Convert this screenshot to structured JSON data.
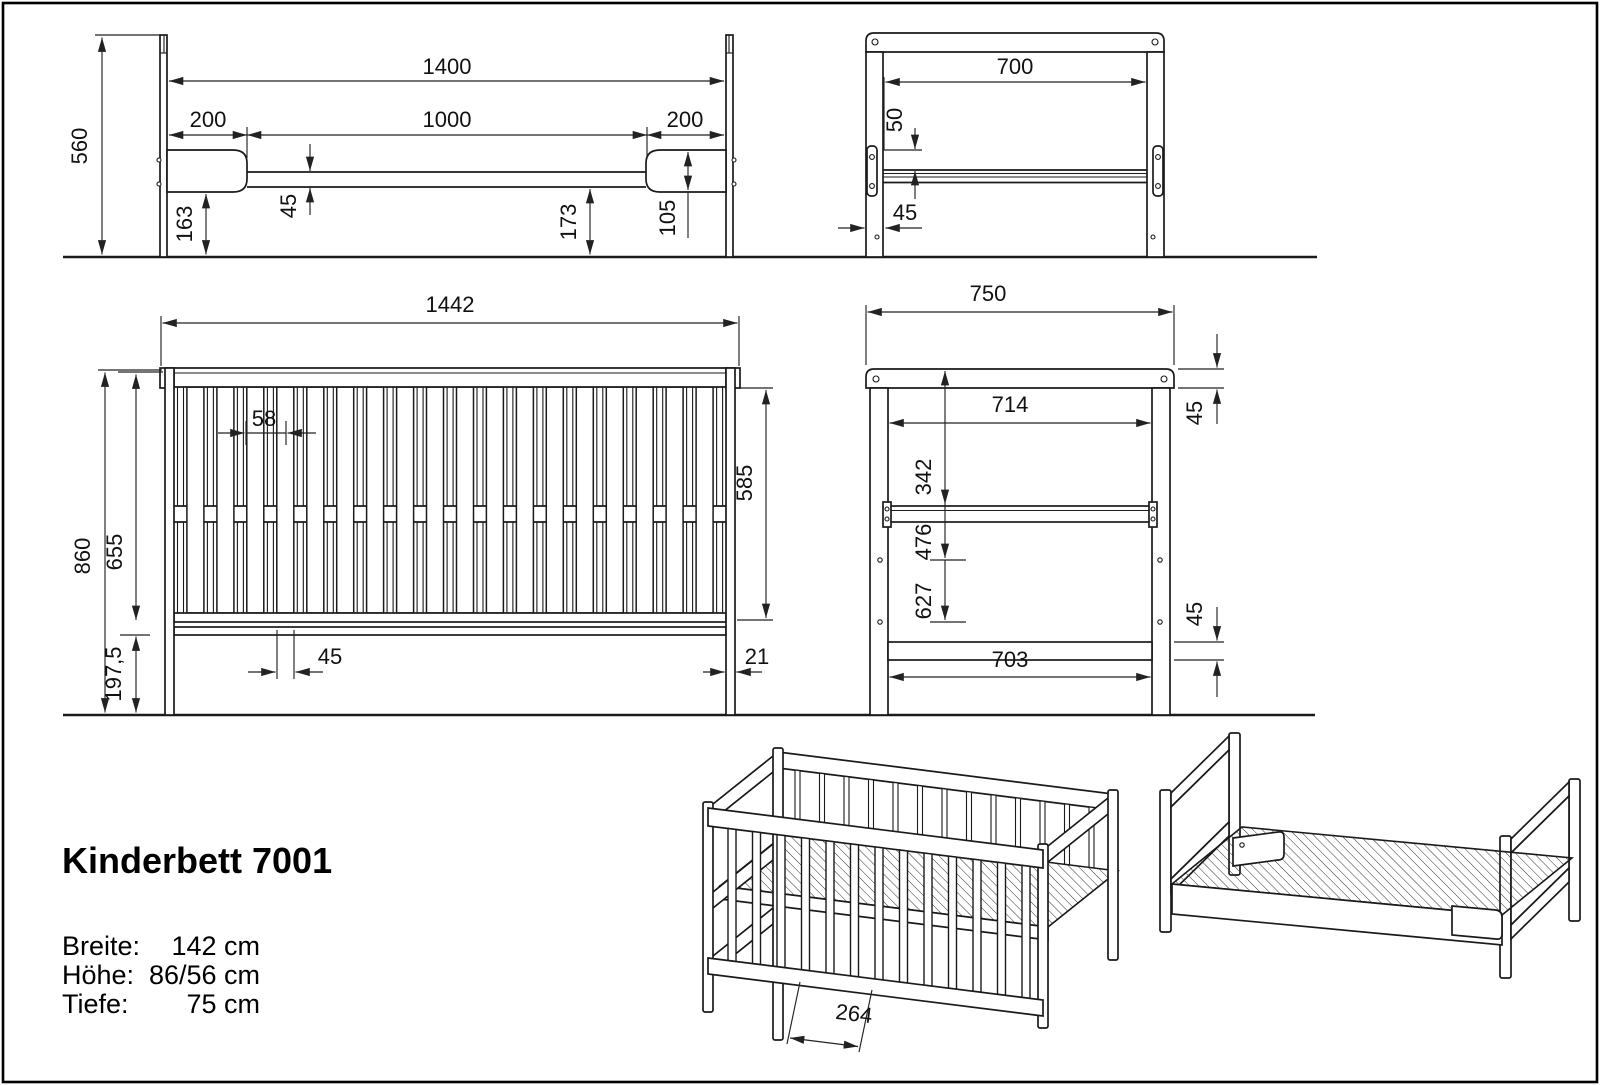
{
  "product": {
    "title": "Kinderbett 7001",
    "specs": [
      {
        "label": "Breite:",
        "value": "142 cm"
      },
      {
        "label": "Höhe:",
        "value": "86/56 cm"
      },
      {
        "label": "Tiefe:",
        "value": "75 cm"
      }
    ]
  },
  "views": {
    "bed_side": {
      "dims": {
        "total_height": "560",
        "inner_width": "1400",
        "left_section": "200",
        "middle_section": "1000",
        "right_section": "200",
        "bracket_to_floor": "163",
        "rail_thickness": "45",
        "rail_to_floor": "173",
        "bracket_height": "105"
      }
    },
    "bed_end": {
      "dims": {
        "inner_width": "700",
        "rail_drop": "50",
        "post_depth": "45"
      }
    },
    "crib_front": {
      "dims": {
        "total_width": "1442",
        "slat_pitch": "58",
        "total_height": "860",
        "panel_height": "655",
        "base_to_floor": "197,5",
        "side_height": "585",
        "slat_width": "45",
        "post_width": "21"
      }
    },
    "crib_side": {
      "dims": {
        "total_depth": "750",
        "inner_depth": "714",
        "platform_from_top": "342",
        "mid_hole_from_top": "476",
        "low_hole_from_top": "627",
        "bottom_inner_depth": "703",
        "cap_height": "45",
        "bottom_rail_height": "45"
      }
    },
    "crib_iso": {
      "dims": {
        "slat_pitch": "264"
      }
    }
  }
}
